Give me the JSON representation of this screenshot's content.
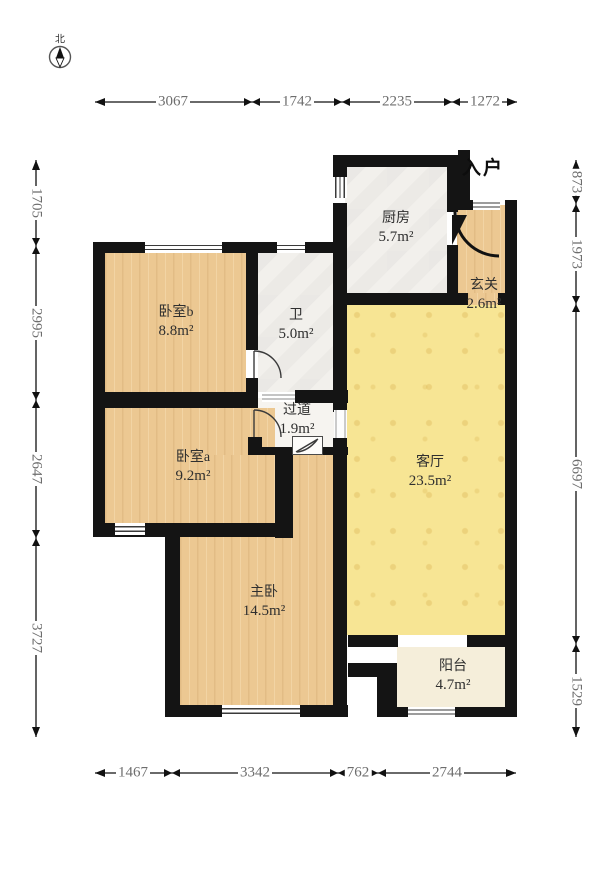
{
  "compass": {
    "north_label": "北"
  },
  "entry_label": "入户",
  "rooms": [
    {
      "id": "kitchen",
      "name": "厨房",
      "area": "5.7m²"
    },
    {
      "id": "hallway",
      "name": "玄关",
      "area": "2.6m²"
    },
    {
      "id": "bedroom_b",
      "name": "卧室b",
      "area": "8.8m²"
    },
    {
      "id": "bathroom",
      "name": "卫",
      "area": "5.0m²"
    },
    {
      "id": "corridor",
      "name": "过道",
      "area": "1.9m²"
    },
    {
      "id": "bedroom_a",
      "name": "卧室a",
      "area": "9.2m²"
    },
    {
      "id": "living_room",
      "name": "客厅",
      "area": "23.5m²"
    },
    {
      "id": "master_bedroom",
      "name": "主卧",
      "area": "14.5m²"
    },
    {
      "id": "balcony",
      "name": "阳台",
      "area": "4.7m²"
    }
  ],
  "dimensions": {
    "top": [
      "3067",
      "1742",
      "2235",
      "1272"
    ],
    "bottom": [
      "1467",
      "3342",
      "762",
      "2744"
    ],
    "left": [
      "1705",
      "2995",
      "2647",
      "3727"
    ],
    "right": [
      "873",
      "1973",
      "6697",
      "1529"
    ]
  },
  "colors": {
    "wall": "#141414",
    "wood_floor": "#ecc892",
    "tile_yellow": "#f7e594",
    "tile_gray": "#f2f0ec",
    "balcony_cream": "#f5eeda",
    "dimension_text": "#6d6d6d"
  }
}
